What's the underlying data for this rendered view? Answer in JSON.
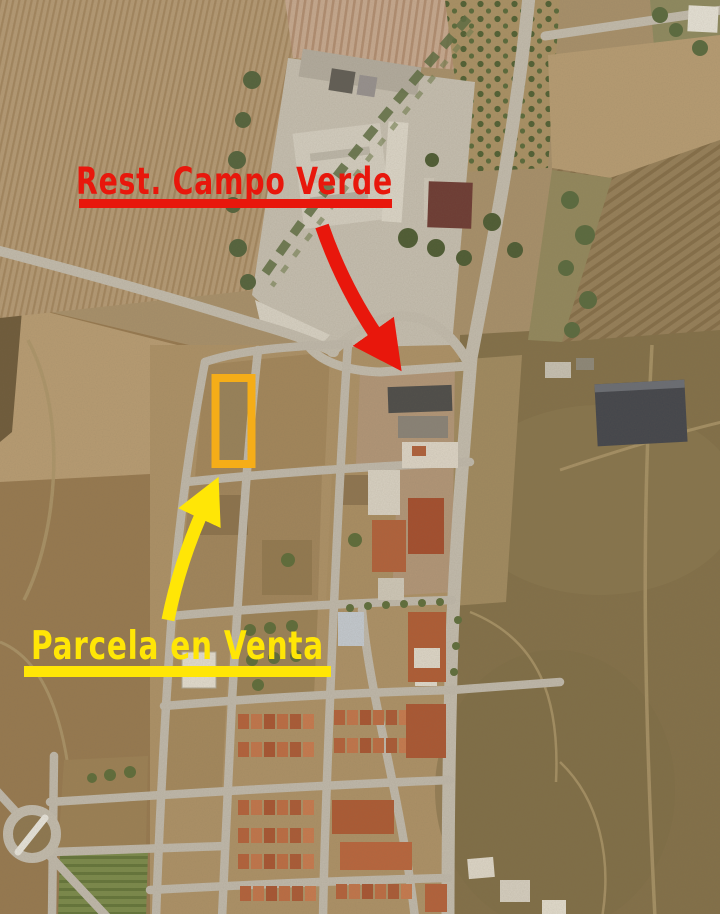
{
  "map": {
    "type": "satellite-aerial-photo"
  },
  "annotations": {
    "restaurant": {
      "label": "Rest. Campo Verde",
      "color": "#e8170c",
      "underline": true,
      "arrow": true
    },
    "parcel": {
      "label": "Parcela en Venta",
      "color": "#ffe606",
      "underline": true,
      "arrow": true,
      "highlight_box_color": "#f5ad18"
    }
  }
}
